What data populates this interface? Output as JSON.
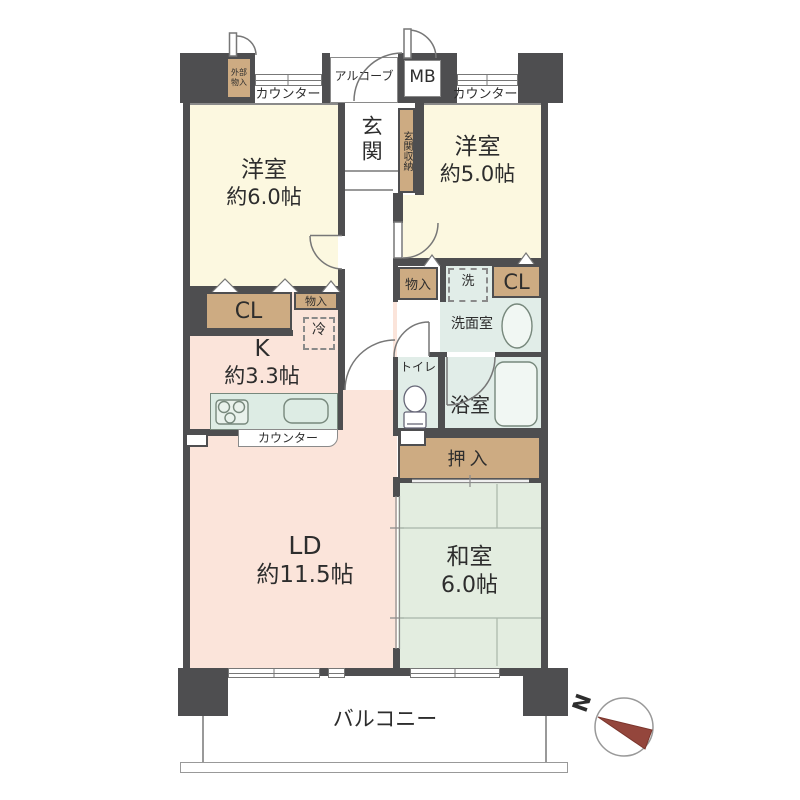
{
  "rooms": {
    "western6": {
      "name": "洋室",
      "size": "約6.0帖"
    },
    "western5": {
      "name": "洋室",
      "size": "約5.0帖"
    },
    "kitchen": {
      "name": "K",
      "size": "約3.3帖"
    },
    "living_dining": {
      "name": "LD",
      "size": "約11.5帖"
    },
    "japanese": {
      "name": "和室",
      "size": "6.0帖"
    },
    "entrance": {
      "name": "玄関"
    },
    "entrance_storage": {
      "name": "玄関収納"
    },
    "washroom": {
      "name": "洗面室"
    },
    "bathroom": {
      "name": "浴室"
    },
    "toilet": {
      "name": "トイレ"
    },
    "oshiire": {
      "name": "押入"
    },
    "balcony": {
      "name": "バルコニー"
    },
    "alcove": {
      "name": "アルコーブ"
    },
    "meter_box": {
      "name": "MB"
    },
    "exterior_storage": {
      "name": "外部物入"
    }
  },
  "storage": {
    "cl_left": "CL",
    "cl_right": "CL",
    "monoire_left": "物入",
    "monoire_right": "物入"
  },
  "fixtures": {
    "refrigerator": "冷",
    "washer": "洗",
    "counter_left": "カウンター",
    "counter_right": "カウンター",
    "kitchen_counter": "カウンター"
  },
  "compass": {
    "north": "N"
  },
  "colors": {
    "wall": "#4e4e50",
    "western_room": "#fcf8e0",
    "closet_tan": "#cdab82",
    "living_pink": "#fbe4da",
    "wet_mint": "#e1ede8",
    "tatami_green": "#e3ede0",
    "north_arrow": "#94463c"
  }
}
